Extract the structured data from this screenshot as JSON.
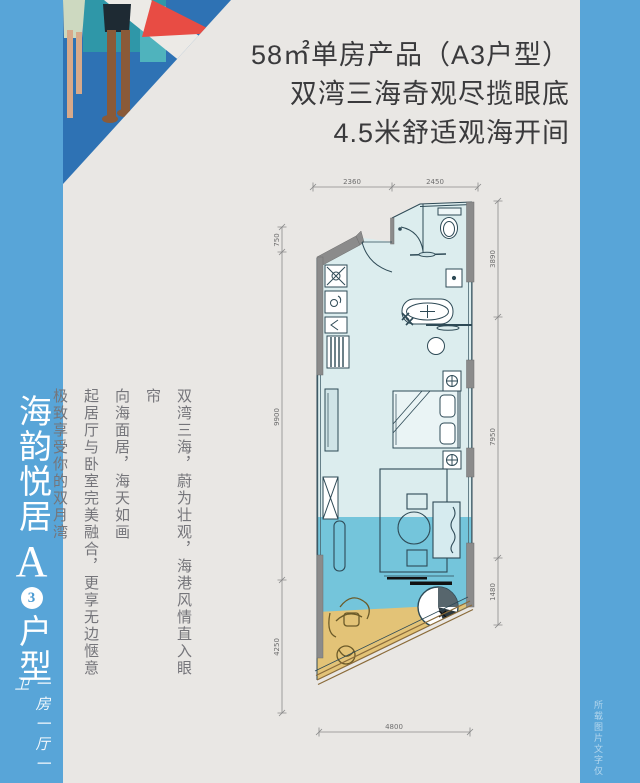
{
  "page": {
    "background": "#e9e7e4",
    "accent_blue": "#58a5d8",
    "illustration_blue": "#2e72b4",
    "illustration_red": "#e84c44"
  },
  "headline": {
    "lines": [
      "58㎡单房产品（A3户型）",
      "双湾三海奇观尽揽眼底",
      "4.5米舒适观海开间"
    ]
  },
  "left_bar": {
    "title": "海韵悦居",
    "type_letter": "A",
    "type_number": "3",
    "type_label": "户型",
    "subtitle": "一房一厅一卫"
  },
  "description": {
    "columns": [
      "双湾三海，蔚为壮观，海港风情直入眼帘",
      "向海面居，海天如画",
      "起居厅与卧室完美融合，更享无边惬意",
      "极致享受你的双月湾"
    ]
  },
  "floorplan": {
    "colors": {
      "room": "#dcedee",
      "water_band": "#74c5db",
      "sand": "#e3c377",
      "wall": "#8b8b8b",
      "line": "#2e4a56"
    },
    "dims_top": [
      "2360",
      "2450"
    ],
    "dims_left": [
      "750",
      "9900",
      "4250"
    ],
    "dims_right": [
      "3890",
      "7950",
      "1480"
    ],
    "dims_bottom": [
      "4800"
    ]
  },
  "watermark": {
    "text": "所载图片文字仅"
  }
}
